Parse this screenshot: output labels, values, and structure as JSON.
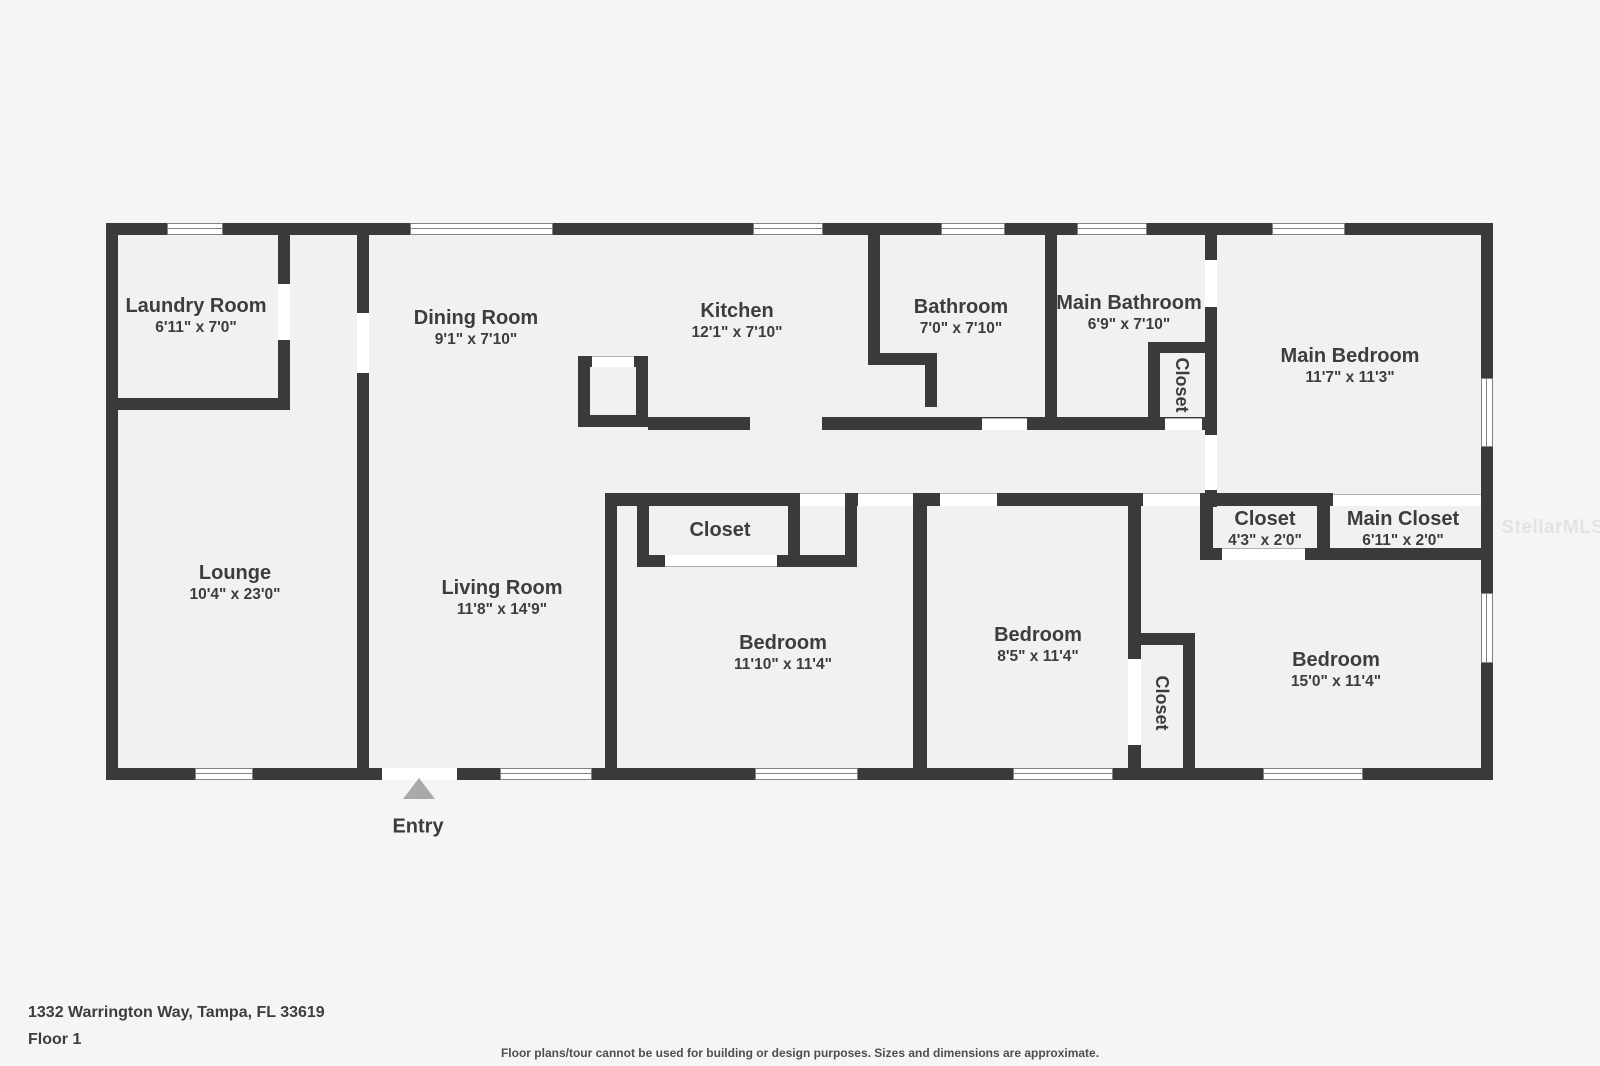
{
  "plan": {
    "rooms": [
      {
        "name": "Laundry Room",
        "dims": "6'11\" x 7'0\""
      },
      {
        "name": "Dining Room",
        "dims": "9'1\" x 7'10\""
      },
      {
        "name": "Kitchen",
        "dims": "12'1\" x 7'10\""
      },
      {
        "name": "Bathroom",
        "dims": "7'0\" x 7'10\""
      },
      {
        "name": "Main Bathroom",
        "dims": "6'9\" x 7'10\""
      },
      {
        "name": "Main Bedroom",
        "dims": "11'7\" x 11'3\""
      },
      {
        "name": "Lounge",
        "dims": "10'4\" x 23'0\""
      },
      {
        "name": "Living Room",
        "dims": "11'8\" x 14'9\""
      },
      {
        "name": "Closet"
      },
      {
        "name": "Bedroom",
        "dims": "11'10\" x 11'4\""
      },
      {
        "name": "Bedroom",
        "dims": "8'5\" x 11'4\""
      },
      {
        "name": "Bedroom",
        "dims": "15'0\" x 11'4\""
      },
      {
        "name": "Closet",
        "dims": "4'3\" x 2'0\""
      },
      {
        "name": "Main Closet",
        "dims": "6'11\" x 2'0\""
      },
      {
        "name": "Closet"
      },
      {
        "name": "Closet"
      }
    ],
    "entry_label": "Entry"
  },
  "footer": {
    "address": "1332 Warrington Way, Tampa, FL 33619",
    "floor_label": "Floor 1",
    "disclaimer": "Floor plans/tour cannot be used for building or design purposes. Sizes and dimensions are approximate."
  },
  "watermark": "StellarMLS",
  "colors": {
    "wall": "#3a3a3a",
    "floor": "#f1f1f1",
    "background": "#f5f5f5",
    "entry_arrow": "#a9a9a9",
    "text": "#3d3d3d"
  }
}
